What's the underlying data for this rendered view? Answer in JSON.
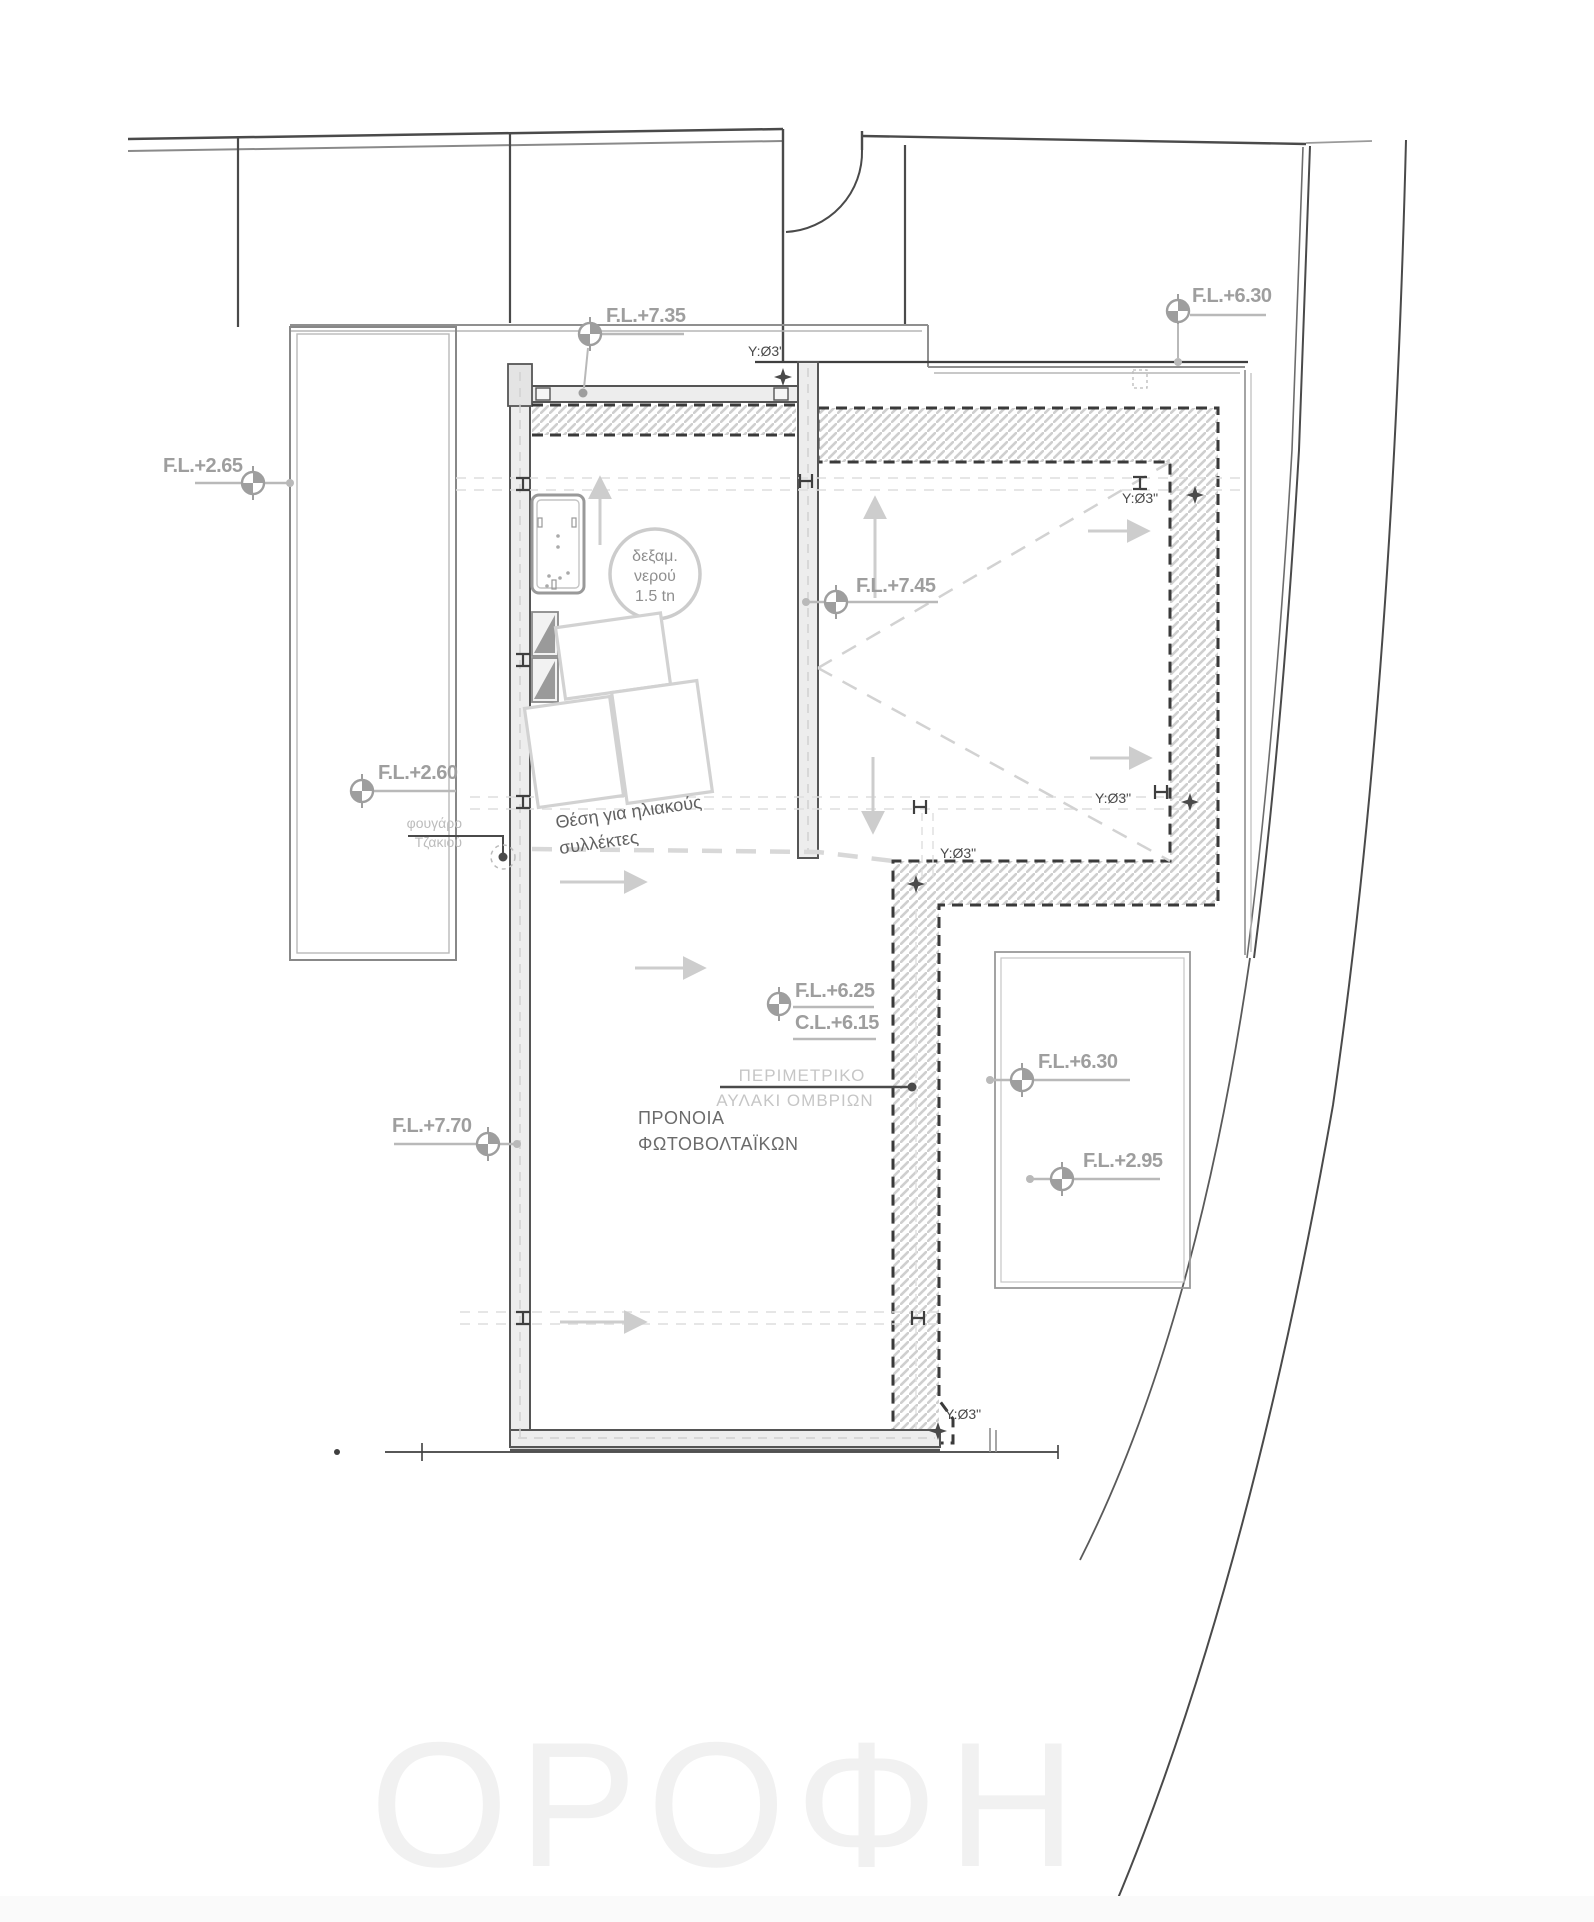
{
  "watermark": "ΟΡΟΦΗ",
  "levels": {
    "fl_735": "F.L.+7.35",
    "fl_630_top": "F.L.+6.30",
    "fl_265": "F.L.+2.65",
    "fl_745": "F.L.+7.45",
    "fl_260": "F.L.+2.60",
    "fl_625": "F.L.+6.25",
    "cl_615": "C.L.+6.15",
    "fl_770": "F.L.+7.70",
    "fl_630_right": "F.L.+6.30",
    "fl_295": "F.L.+2.95"
  },
  "drain_label": "Y:Ø3\"",
  "notes": {
    "tank_1": "δεξαμ.",
    "tank_2": "νερού",
    "tank_3": "1.5 tn",
    "solar_1": "Θέση για ηλιακούς",
    "solar_2": "συλλέκτες",
    "chimney_1": "φουγάρο",
    "chimney_2": "Τζακιού",
    "gutter_1": "ΠΕΡΙΜΕΤΡΙΚΟ",
    "gutter_2": "ΑΥΛΑΚΙ ΟΜΒΡΙΩΝ",
    "pv_1": "ΠΡΟΝΟΙΑ",
    "pv_2": "ΦΩΤΟΒΟΛΤΑΪΚΩΝ",
    "hp": "Η.Π"
  },
  "colors": {
    "line_dark": "#3f3f3f",
    "line_gray": "#8a8a8a",
    "line_light": "#c9c9c9",
    "label_gray": "#9e9e9e",
    "hatch": "#cfcfcf",
    "watermark": "#f1f1f1"
  }
}
